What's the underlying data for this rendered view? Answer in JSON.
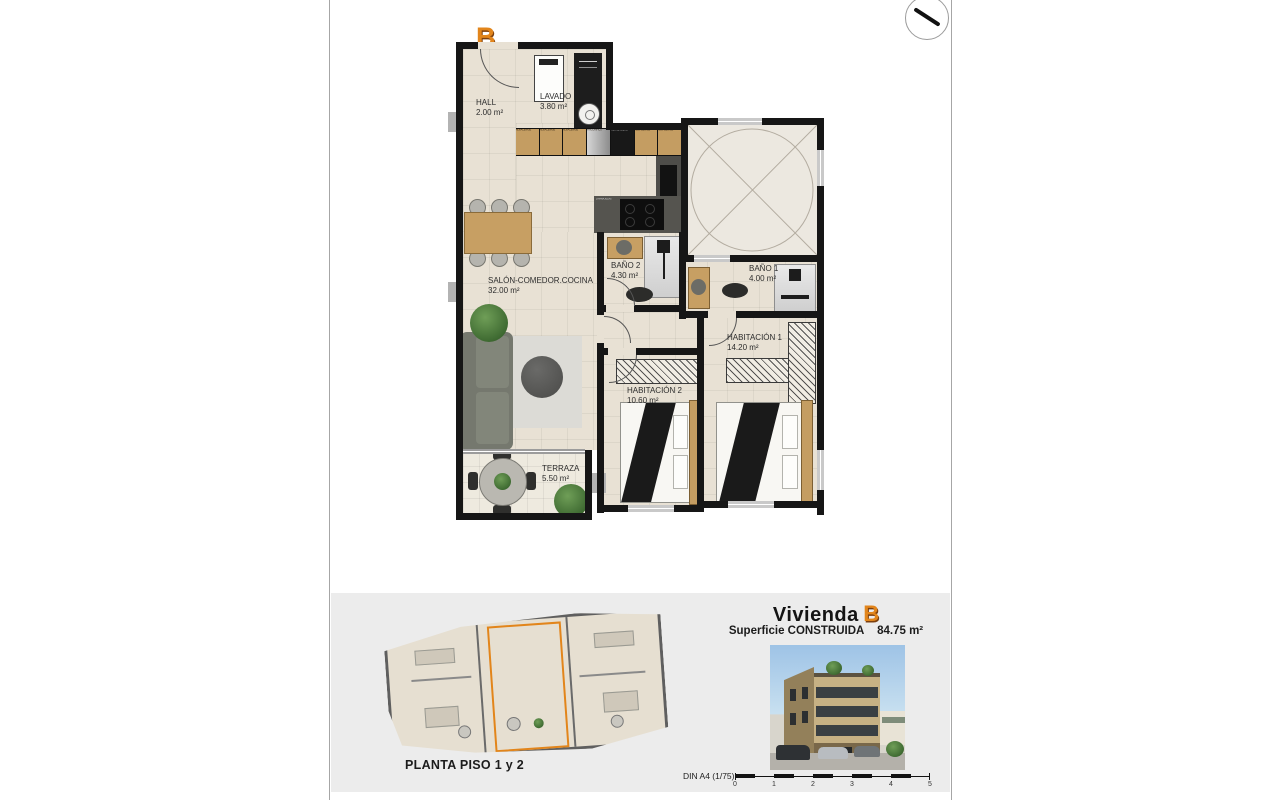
{
  "sheet": {
    "unit_badge": "B",
    "north_arrow_icon": "compass-needle"
  },
  "plan": {
    "rooms": [
      {
        "name": "HALL",
        "area": "2.00 m²"
      },
      {
        "name": "LAVADO",
        "area": "3.80 m²"
      },
      {
        "name": "SALÓN-COMEDOR.COCINA",
        "area": "32.00 m²"
      },
      {
        "name": "BAÑO 2",
        "area": "4.30 m²"
      },
      {
        "name": "BAÑO 1",
        "area": "4.00 m²"
      },
      {
        "name": "HABITACIÓN 1",
        "area": "14.20 m²"
      },
      {
        "name": "HABITACIÓN 2",
        "area": "10.60 m²"
      },
      {
        "name": "TERRAZA",
        "area": "5.50 m²"
      }
    ],
    "kitchen_cabinet_labels": [
      "ALMACENAJE",
      "ALMACENAJE",
      "ALMACENAJE",
      "FRIGORIFICO",
      "HORNO MICRO",
      "ALMACENAJE",
      "ALMACENAJE"
    ],
    "island_label": "LAVAVAJILLAS"
  },
  "footer": {
    "overview_caption": "PLANTA PISO 1 y 2",
    "title_prefix": "Vivienda",
    "title_unit": "B",
    "surface_label": "Superficie CONSTRUIDA",
    "surface_value": "84.75 m²",
    "scale_label": "DIN A4 (1/75)",
    "scale_ticks": [
      "0",
      "1",
      "2",
      "3",
      "4",
      "5"
    ]
  },
  "colors": {
    "accent_orange": "#E2851B",
    "wall_black": "#161616",
    "floor_beige": "#E8E1D4",
    "panel_gray": "#ECECEC"
  }
}
